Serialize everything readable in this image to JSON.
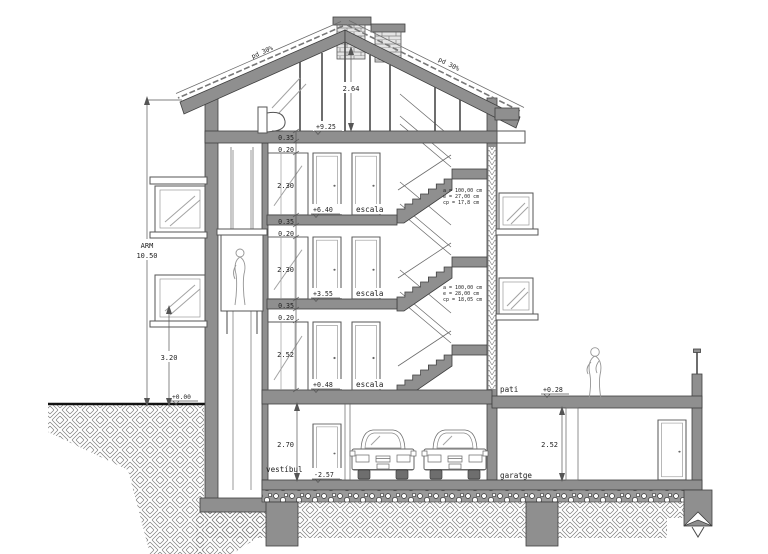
{
  "drawing_type": "building-cross-section",
  "labels": {
    "arm": "ARM",
    "arm_value": "10.50",
    "dim_attic": "2.64",
    "lvl_attic": "+9.25",
    "lvl_f3": "+6.40",
    "lvl_f2": "+3.55",
    "lvl_f1": "+0.48",
    "lvl_street": "+0.00",
    "lvl_basement": "-2.57",
    "lvl_pati": "+0.28",
    "dim_slab": "0.35",
    "dim_beam": "0.20",
    "dim_room_upper": "2.30",
    "dim_room_f1": "2.52",
    "dim_left": "3.20",
    "dim_vestibul": "2.70",
    "dim_garatge": "2.52",
    "room_escala": "escala",
    "room_vestibul": "vestíbul",
    "room_garatge": "garatge",
    "room_pati": "pati",
    "slope": "pd 30%",
    "note1": [
      "a = 100,00 cm",
      "e = 27,00 cm",
      "cp = 17,8 cm"
    ],
    "note2": [
      "a = 100,00 cm",
      "e = 28,00 cm",
      "cp = 18,05 cm"
    ]
  },
  "colors": {
    "wall": "#8f8f8f",
    "line": "#3f3f3f",
    "text": "#1f1f1f",
    "background": "#ffffff"
  }
}
